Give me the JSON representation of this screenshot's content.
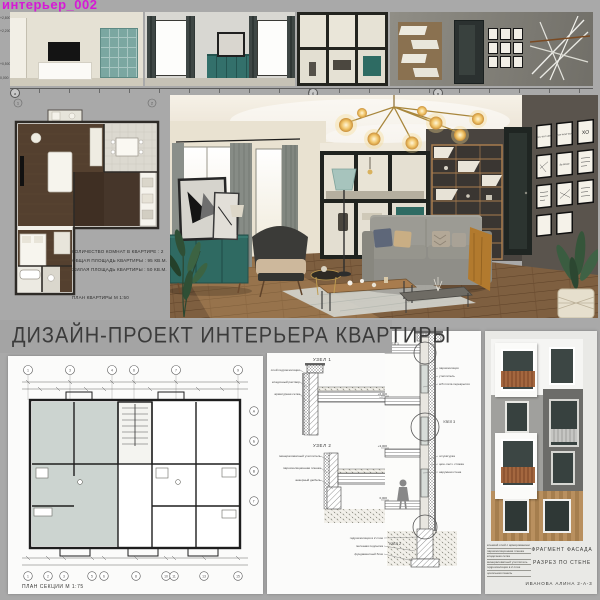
{
  "header": {
    "label": "интерьер_002"
  },
  "title": "ДИЗАЙН-ПРОЕКТ ИНТЕРЬЕРА КВАРТИРЫ",
  "colors": {
    "board_background": "#a9a9a9",
    "header_magenta": "#d619d6",
    "teal_furniture": "#35706a",
    "wood_floor": "#7e5f40",
    "charcoal_wall": "#47433f"
  },
  "elevations": {
    "height_marks": [
      "+2,800",
      "+2,200",
      "+0,500",
      "0,000"
    ],
    "axis_letters": [
      "а",
      "б",
      "в"
    ]
  },
  "apartment": {
    "info_lines": [
      "КОЛИЧЕСТВО КОМНАТ В КВАРТИРЕ : 2",
      "ОБЩАЯ ПЛОЩАДЬ КВАРТИРЫ : 95 КВ.М.",
      "ЖИЛАЯ ПЛОЩАДЬ КВАРТИРЫ : 50 КВ.М."
    ],
    "plan_label": "ПЛАН КВАРТИРЫ М 1:50",
    "plan_axis": [
      "1",
      "2"
    ]
  },
  "render": {
    "posters": [
      "ADV ENT URE",
      "WOW WOW WOW",
      "XO",
      "Be Brave"
    ]
  },
  "section_plan": {
    "label": "ПЛАН СЕКЦИИ  М 1:75",
    "axes_top": [
      "1",
      "3",
      "4",
      "6",
      "7",
      "9"
    ],
    "axes_bottom": [
      "1",
      "2",
      "3",
      "5",
      "6",
      "8",
      "10",
      "11",
      "13",
      "15"
    ],
    "axes_right": [
      "А",
      "Б",
      "В",
      "Г"
    ]
  },
  "details": {
    "node1": "УЗЕЛ 1",
    "node2": "УЗЕЛ 2",
    "node3": "УЗЕЛ 3",
    "annotations_left": [
      "слой гидроизоляции",
      "кладочный раствор",
      "арматурная сетка",
      "минераловатный утеплитель",
      "пароизоляционная пленка",
      "анкерный дюбель"
    ],
    "annotations_right": [
      "ж/б плита перекрытия",
      "цем.-песч. стяжка",
      "штукатурка по сетке"
    ],
    "section_labels": [
      "пароизоляция",
      "утеплитель",
      "ж/б плита перекрытия",
      "штукатурка",
      "цем.-песч. стяжка",
      "наружная стена",
      "гидроизоляция в 2 слоя",
      "песчаная подсыпка",
      "фундаментный блок"
    ],
    "elev_marks": [
      "+9,000",
      "+6,000",
      "+3,000",
      "0,000"
    ]
  },
  "facade": {
    "caption1": "ФРАГМЕНТ ФАСАДА",
    "caption2": "РАЗРЕЗ ПО СТЕНЕ",
    "author": "ИВАНОВА АЛИНА  2-А-3",
    "notes": [
      "клеевой слой с армированием",
      "пароизоляционная пленка",
      "кладочная сетка",
      "минераловатный утеплитель",
      "гидроизоляция в 2 слоя",
      "цокольная панель"
    ]
  }
}
